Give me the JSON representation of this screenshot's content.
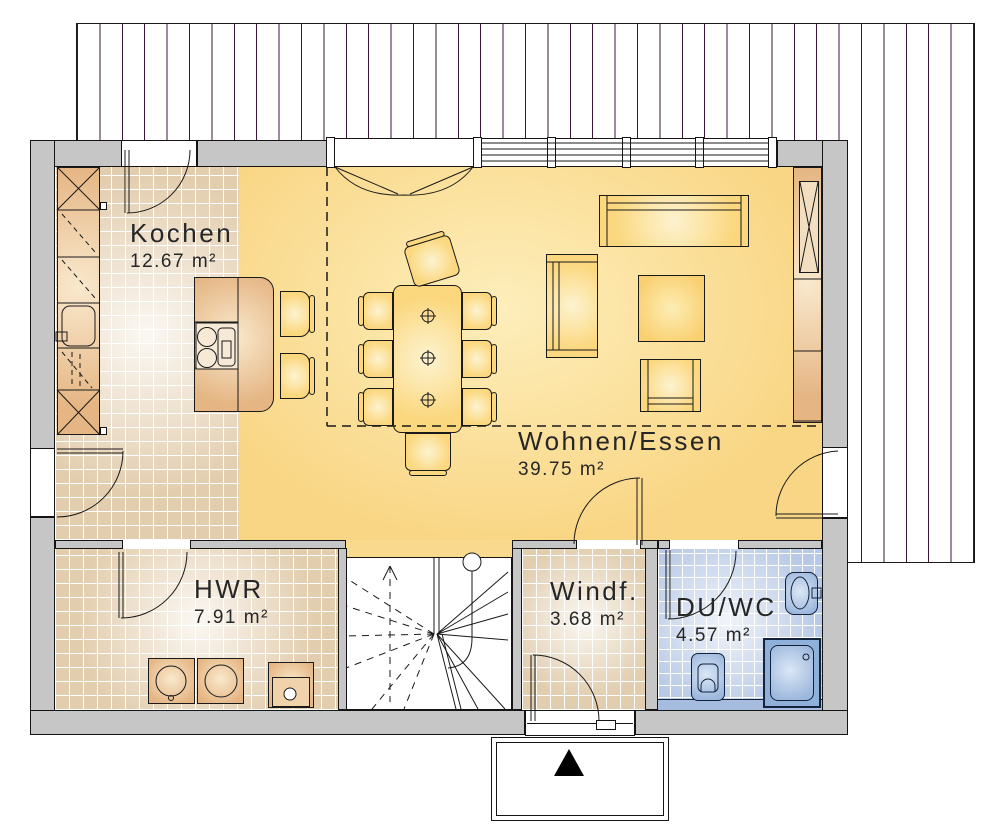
{
  "plan": {
    "rooms": [
      {
        "id": "kochen",
        "name": "Kochen",
        "area": "12.67 m²"
      },
      {
        "id": "wohnen",
        "name": "Wohnen/Essen",
        "area": "39.75 m²"
      },
      {
        "id": "hwr",
        "name": "HWR",
        "area": "7.91 m²"
      },
      {
        "id": "windfang",
        "name": "Windf.",
        "area": "3.68 m²"
      },
      {
        "id": "duwc",
        "name": "DU/WC",
        "area": "4.57 m²"
      }
    ],
    "colors": {
      "wall_gray": "#c6c6c6",
      "living_floor": "#f9d685",
      "tile_beige": "#e2cdae",
      "tile_blue": "#b7c9e6",
      "furniture_yellow": "#fbd77d",
      "cabinet_wood": "#e5b583",
      "bath_fixture_blue": "#9db8dd",
      "deck_line_purple": "#3a1535",
      "line_black": "#1a1a1a"
    },
    "icons": {
      "entrance_marker": "black triangle"
    }
  }
}
